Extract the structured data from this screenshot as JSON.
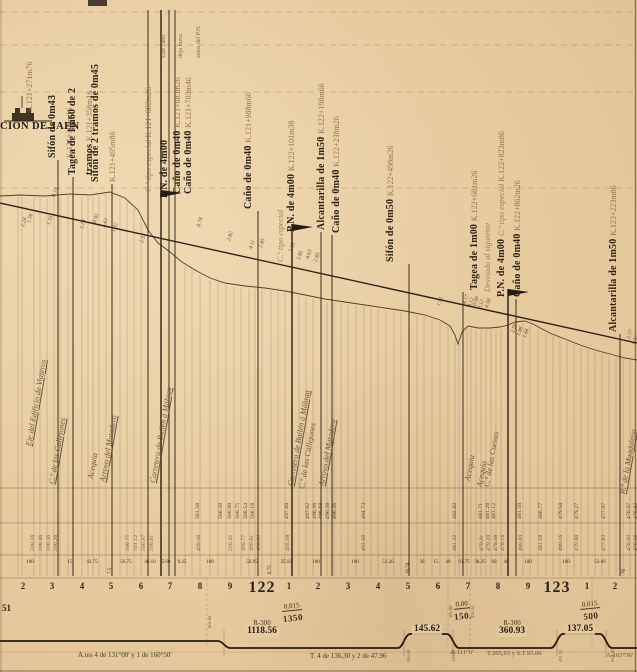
{
  "sheet": {
    "paper_color": "#e8cca1",
    "ink_color": "#33281b",
    "faded_ink_color": "#80603a"
  },
  "station": {
    "name": "CIÓN DE JAEN"
  },
  "events": [
    {
      "label_x": 19,
      "pole_x": null,
      "bottom": 112,
      "flag": false,
      "lines": [
        [
          {
            "t": "K.121+271m76",
            "s": "faded"
          }
        ]
      ]
    },
    {
      "label_x": 42,
      "pole_x": 58,
      "bottom": 158,
      "flag": false,
      "lines": [
        [
          {
            "t": "Sifón de 0m43",
            "s": "bold"
          }
        ],
        [
          {
            "t": "K.121+308m16",
            "s": "faded"
          }
        ]
      ]
    },
    {
      "label_x": 62,
      "pole_x": 73,
      "bottom": 175,
      "flag": false,
      "lines": [
        [
          {
            "t": "Tagea de 1m60 de 2",
            "s": "bold"
          }
        ],
        [
          {
            "t": "tramos ",
            "s": "bold"
          },
          {
            "t": "K.121+358m16",
            "s": "faded"
          }
        ]
      ]
    },
    {
      "label_x": 85,
      "pole_x": 112,
      "bottom": 182,
      "flag": false,
      "lines": [
        [
          {
            "t": "Sifón de 2 tramos de 0m45",
            "s": "bold"
          }
        ],
        [
          {
            "t": "K.121+495m86",
            "s": "faded"
          }
        ]
      ]
    },
    {
      "label_x": 138,
      "pole_x": 148,
      "bottom": 192,
      "line_top": 10,
      "flag": false,
      "lines": [
        [
          {
            "t": "C.º tipo especial ",
            "s": "faded-italic"
          },
          {
            "t": "K.121+682m26",
            "s": "faded"
          }
        ]
      ]
    },
    {
      "label_x": 152,
      "pole_x": null,
      "bottom": 58,
      "flag": false,
      "lines": [
        [
          {
            "t": "Este caño",
            "s": "tiny"
          }
        ],
        [
          {
            "t": "deja fuera",
            "s": "tiny"
          }
        ],
        [
          {
            "t": "antes del P.N.",
            "s": "tiny"
          }
        ]
      ]
    },
    {
      "label_x": 154,
      "pole_x": 161,
      "bottom": 198,
      "line_top": 10,
      "flag": true,
      "lines": [
        [
          {
            "t": "P.N. de 4m00",
            "s": "bold"
          }
        ]
      ]
    },
    {
      "label_x": 167,
      "pole_x": 169,
      "bottom": 194,
      "line_top": 10,
      "flag": false,
      "lines": [
        [
          {
            "t": "Caño de 0m40 ",
            "s": "bold"
          },
          {
            "t": "K.121+683m26",
            "s": "faded"
          }
        ]
      ]
    },
    {
      "label_x": 178,
      "pole_x": 175,
      "bottom": 194,
      "line_top": 10,
      "flag": false,
      "lines": [
        [
          {
            "t": "Caño de 0m40 ",
            "s": "bold"
          },
          {
            "t": "K.121+703m46",
            "s": "faded"
          }
        ]
      ]
    },
    {
      "label_x": 238,
      "pole_x": 258,
      "bottom": 209,
      "flag": false,
      "lines": [
        [
          {
            "t": "Caño de 0m40 ",
            "s": "bold"
          },
          {
            "t": "K.121+988m66",
            "s": "faded"
          }
        ]
      ]
    },
    {
      "label_x": 270,
      "pole_x": null,
      "bottom": 262,
      "flag": false,
      "lines": [
        [
          {
            "t": "C.º tipo especial",
            "s": "faded-italic"
          }
        ]
      ]
    },
    {
      "label_x": 281,
      "pole_x": 292,
      "bottom": 232,
      "flag": true,
      "lines": [
        [
          {
            "t": "P.N. de 4m00 ",
            "s": "bold"
          },
          {
            "t": "K.122+101m38",
            "s": "faded"
          }
        ]
      ]
    },
    {
      "label_x": 311,
      "pole_x": 321,
      "bottom": 230,
      "flag": false,
      "lines": [
        [
          {
            "t": "Alcantarilla de 1m50 ",
            "s": "bold"
          },
          {
            "t": "K.122+198m66",
            "s": "faded"
          }
        ]
      ]
    },
    {
      "label_x": 326,
      "pole_x": 332,
      "bottom": 233,
      "flag": false,
      "lines": [
        [
          {
            "t": "Caño de 0m40 ",
            "s": "bold"
          },
          {
            "t": "K.122+238m26",
            "s": "faded"
          }
        ]
      ]
    },
    {
      "label_x": 380,
      "pole_x": 409,
      "bottom": 262,
      "flag": false,
      "lines": [
        [
          {
            "t": "Sifón de 0m50 ",
            "s": "bold"
          },
          {
            "t": "K.122+498m26",
            "s": "faded"
          }
        ]
      ]
    },
    {
      "label_x": 464,
      "pole_x": 463,
      "bottom": 290,
      "flag": false,
      "lines": [
        [
          {
            "t": "Tagea de 1m00 ",
            "s": "bold"
          },
          {
            "t": "K.122+681m26",
            "s": "faded"
          }
        ]
      ]
    },
    {
      "label_x": 477,
      "pole_x": null,
      "bottom": 292,
      "flag": false,
      "lines": [
        [
          {
            "t": "Desviado al siguiente",
            "s": "faded-italic"
          }
        ]
      ]
    },
    {
      "label_x": 491,
      "pole_x": 508,
      "bottom": 297,
      "flag": true,
      "lines": [
        [
          {
            "t": "P.N. de 4m00 ",
            "s": "bold"
          },
          {
            "t": "C.º tipo especial ",
            "s": "faded-italic"
          },
          {
            "t": "K.122+823m86",
            "s": "faded"
          }
        ]
      ]
    },
    {
      "label_x": 507,
      "pole_x": 516,
      "bottom": 297,
      "flag": false,
      "lines": [
        [
          {
            "t": "Caño de 0m40 ",
            "s": "bold"
          },
          {
            "t": "K.122+862m26",
            "s": "faded"
          }
        ]
      ]
    },
    {
      "label_x": 603,
      "pole_x": 620,
      "bottom": 332,
      "flag": false,
      "lines": [
        [
          {
            "t": "Alcantarilla de 1m50 ",
            "s": "bold"
          },
          {
            "t": "K.123+223m86",
            "s": "faded"
          }
        ]
      ]
    }
  ],
  "features": [
    {
      "x": 24,
      "bottom": 445,
      "t": "Eje del Edificio de Viajeros",
      "u": true
    },
    {
      "x": 47,
      "bottom": 483,
      "t": "C.º de las Callejones",
      "u": true
    },
    {
      "x": 86,
      "bottom": 478,
      "t": "Acequia",
      "u": false
    },
    {
      "x": 98,
      "bottom": 481,
      "t": "Arroyo del Matadero",
      "u": true
    },
    {
      "x": 148,
      "bottom": 482,
      "t": "Carretera de Bailén á Málaga",
      "u": true
    },
    {
      "x": 286,
      "bottom": 485,
      "t": "Carretera de Bailén á Málaga",
      "u": true
    },
    {
      "x": 297,
      "bottom": 488,
      "t": "C.º de las Callejones",
      "u": false
    },
    {
      "x": 317,
      "bottom": 485,
      "t": "Arroyo del Matadero",
      "u": true
    },
    {
      "x": 463,
      "bottom": 480,
      "t": "Acequia",
      "u": false
    },
    {
      "x": 475,
      "bottom": 486,
      "t": "Acequia",
      "u": false
    },
    {
      "x": 482,
      "bottom": 486,
      "t": "C.ª de las Cuevas",
      "u": false
    },
    {
      "x": 618,
      "bottom": 493,
      "t": "R.º de la Magdalena",
      "u": true
    }
  ],
  "cutfill_numbers": [
    {
      "x": 20,
      "y": 226,
      "t": "1.24"
    },
    {
      "x": 26,
      "y": 222,
      "t": "1.56"
    },
    {
      "x": 46,
      "y": 224,
      "t": "1.35"
    },
    {
      "x": 51,
      "y": 196,
      "t": "0.19"
    },
    {
      "x": 79,
      "y": 228,
      "t": "1.74"
    },
    {
      "x": 92,
      "y": 222,
      "t": "0.95"
    },
    {
      "x": 101,
      "y": 227,
      "t": "1.43"
    },
    {
      "x": 111,
      "y": 231,
      "t": "1.32"
    },
    {
      "x": 139,
      "y": 242,
      "t": "2.37"
    },
    {
      "x": 196,
      "y": 226,
      "t": "0.78"
    },
    {
      "x": 226,
      "y": 240,
      "t": "2.82"
    },
    {
      "x": 248,
      "y": 248,
      "t": "4.11"
    },
    {
      "x": 258,
      "y": 247,
      "t": "2.85"
    },
    {
      "x": 288,
      "y": 251,
      "t": "2.18"
    },
    {
      "x": 296,
      "y": 259,
      "t": "2.85"
    },
    {
      "x": 305,
      "y": 258,
      "t": "4.63"
    },
    {
      "x": 313,
      "y": 261,
      "t": "2.85"
    },
    {
      "x": 436,
      "y": 305,
      "t": "1.51"
    },
    {
      "x": 462,
      "y": 303,
      "t": "4.17"
    },
    {
      "x": 467,
      "y": 306,
      "t": "4.12"
    },
    {
      "x": 472,
      "y": 305,
      "t": "0.98"
    },
    {
      "x": 477,
      "y": 308,
      "t": "0.12"
    },
    {
      "x": 484,
      "y": 307,
      "t": "4.50"
    },
    {
      "x": 510,
      "y": 332,
      "t": "2.56"
    },
    {
      "x": 516,
      "y": 335,
      "t": "1.08"
    },
    {
      "x": 522,
      "y": 337,
      "t": "1.66"
    },
    {
      "x": 626,
      "y": 338,
      "t": "2.77"
    },
    {
      "x": 631,
      "y": 344,
      "t": "1.42"
    }
  ],
  "elevation_rows": {
    "terrain": [
      {
        "x": 195,
        "t": "501.56"
      },
      {
        "x": 218,
        "t": "500.50"
      },
      {
        "x": 227,
        "t": "500.90"
      },
      {
        "x": 235,
        "t": "500.75"
      },
      {
        "x": 243,
        "t": "500.54"
      },
      {
        "x": 250,
        "t": "500.16"
      },
      {
        "x": 284,
        "t": "497.88"
      },
      {
        "x": 305,
        "t": "497.02"
      },
      {
        "x": 312,
        "t": "496.96"
      },
      {
        "x": 318,
        "t": "496.68"
      },
      {
        "x": 325,
        "t": "496.38"
      },
      {
        "x": 332,
        "t": "496.26"
      },
      {
        "x": 361,
        "t": "494.73"
      },
      {
        "x": 452,
        "t": "482.82"
      },
      {
        "x": 478,
        "t": "481.71"
      },
      {
        "x": 485,
        "t": "481.26"
      },
      {
        "x": 491,
        "t": "481.12"
      },
      {
        "x": 517,
        "t": "481.50"
      },
      {
        "x": 538,
        "t": "480.77"
      },
      {
        "x": 558,
        "t": "479.58"
      },
      {
        "x": 574,
        "t": "479.27"
      },
      {
        "x": 601,
        "t": "477.97"
      },
      {
        "x": 626,
        "t": "476.97"
      },
      {
        "x": 633,
        "t": "476.82"
      }
    ],
    "grade": [
      {
        "x": 30,
        "t": "500.56"
      },
      {
        "x": 38,
        "t": "500.46"
      },
      {
        "x": 46,
        "t": "500.36"
      },
      {
        "x": 53,
        "t": "500.26"
      },
      {
        "x": 125,
        "t": "500.75"
      },
      {
        "x": 133,
        "t": "501.12"
      },
      {
        "x": 141,
        "t": "500.97"
      },
      {
        "x": 149,
        "t": "500.81"
      },
      {
        "x": 196,
        "t": "499.06"
      },
      {
        "x": 228,
        "t": "500.35"
      },
      {
        "x": 241,
        "t": "499.77"
      },
      {
        "x": 249,
        "t": "499.61"
      },
      {
        "x": 256,
        "t": "498.80"
      },
      {
        "x": 285,
        "t": "495.08"
      },
      {
        "x": 361,
        "t": "491.68"
      },
      {
        "x": 452,
        "t": "481.32"
      },
      {
        "x": 479,
        "t": "479.31"
      },
      {
        "x": 486,
        "t": "479.20"
      },
      {
        "x": 493,
        "t": "478.08"
      },
      {
        "x": 500,
        "t": "478.16"
      },
      {
        "x": 518,
        "t": "480.80"
      },
      {
        "x": 538,
        "t": "481.68"
      },
      {
        "x": 558,
        "t": "480.16"
      },
      {
        "x": 574,
        "t": "479.88"
      },
      {
        "x": 601,
        "t": "477.83"
      },
      {
        "x": 626,
        "t": "478.90"
      },
      {
        "x": 633,
        "t": "476.98"
      }
    ]
  },
  "distances": [
    {
      "x": 30,
      "t": "100",
      "v": false
    },
    {
      "x": 70,
      "t": "15",
      "v": false
    },
    {
      "x": 92,
      "t": "43.75",
      "v": false
    },
    {
      "x": 108,
      "t": "7.5",
      "v": true
    },
    {
      "x": 126,
      "t": "56.75",
      "v": false
    },
    {
      "x": 150,
      "t": "46.10",
      "v": false
    },
    {
      "x": 166,
      "t": "5.60",
      "v": false
    },
    {
      "x": 182,
      "t": "9.25",
      "v": false
    },
    {
      "x": 210,
      "t": "100",
      "v": false
    },
    {
      "x": 252,
      "t": "56.95",
      "v": false
    },
    {
      "x": 268,
      "t": "8.75",
      "v": true
    },
    {
      "x": 286,
      "t": "35.10",
      "v": false
    },
    {
      "x": 316,
      "t": "100",
      "v": false
    },
    {
      "x": 355,
      "t": "100",
      "v": false
    },
    {
      "x": 388,
      "t": "51.26",
      "v": false
    },
    {
      "x": 406,
      "t": "16.74",
      "v": true
    },
    {
      "x": 422,
      "t": "36",
      "v": false
    },
    {
      "x": 436,
      "t": "15",
      "v": false
    },
    {
      "x": 448,
      "t": "40",
      "v": false
    },
    {
      "x": 464,
      "t": "61.75",
      "v": false
    },
    {
      "x": 480,
      "t": "38.25",
      "v": false
    },
    {
      "x": 494,
      "t": "60",
      "v": false
    },
    {
      "x": 506,
      "t": "40",
      "v": false
    },
    {
      "x": 528,
      "t": "100",
      "v": false
    },
    {
      "x": 566,
      "t": "100",
      "v": false
    },
    {
      "x": 600,
      "t": "53.66",
      "v": false
    },
    {
      "x": 622,
      "t": "76",
      "v": true
    }
  ],
  "hectometers": [
    {
      "x": 23,
      "t": "2"
    },
    {
      "x": 52,
      "t": "3"
    },
    {
      "x": 82,
      "t": "4"
    },
    {
      "x": 111,
      "t": "5"
    },
    {
      "x": 141,
      "t": "6"
    },
    {
      "x": 170,
      "t": "7"
    },
    {
      "x": 200,
      "t": "8"
    },
    {
      "x": 230,
      "t": "9"
    },
    {
      "x": 289,
      "t": "1"
    },
    {
      "x": 318,
      "t": "2"
    },
    {
      "x": 348,
      "t": "3"
    },
    {
      "x": 378,
      "t": "4"
    },
    {
      "x": 408,
      "t": "5"
    },
    {
      "x": 438,
      "t": "6"
    },
    {
      "x": 468,
      "t": "7"
    },
    {
      "x": 498,
      "t": "8"
    },
    {
      "x": 528,
      "t": "9"
    },
    {
      "x": 587,
      "t": "1"
    },
    {
      "x": 615,
      "t": "2"
    }
  ],
  "km_posts": [
    {
      "x": 262,
      "label": "122"
    },
    {
      "x": 557,
      "label": "123"
    }
  ],
  "gradients": [
    {
      "x": 292,
      "y": 595,
      "num": "0.015",
      "den": "1350"
    },
    {
      "x": 462,
      "y": 593,
      "num": "0.00",
      "den": "150."
    },
    {
      "x": 590,
      "y": 593,
      "num": "0.015",
      "den": "500"
    }
  ],
  "band_stations": [
    {
      "x": 207,
      "bottom": 628,
      "t": "866.04"
    },
    {
      "x": 448,
      "bottom": 618,
      "t": "306.08"
    },
    {
      "x": 470,
      "bottom": 618,
      "t": "456.44"
    },
    {
      "x": 406,
      "bottom": 662,
      "t": "984.60"
    },
    {
      "x": 451,
      "bottom": 662,
      "t": "130.22"
    },
    {
      "x": 558,
      "bottom": 662,
      "t": "491.15"
    },
    {
      "x": 610,
      "bottom": 662,
      "t": "628.20"
    }
  ],
  "curve_band": {
    "left_label": "51",
    "segments": [
      {
        "cx": 262,
        "y": 620,
        "r": "R-300",
        "len": "1118.56"
      },
      {
        "cx": 427,
        "y": 625,
        "r": "",
        "len": "145.62"
      },
      {
        "cx": 512,
        "y": 620,
        "r": "R-300",
        "len": "360.93"
      },
      {
        "cx": 580,
        "y": 625,
        "r": "",
        "len": "137.05"
      }
    ],
    "angle_notes": [
      {
        "x": 450,
        "y": 649,
        "t": "A-111°6'"
      },
      {
        "x": 487,
        "y": 650,
        "t": "T.205,93 y S.T.93.06"
      },
      {
        "x": 606,
        "y": 652,
        "t": "A-103°36'"
      }
    ],
    "notes": [
      {
        "x": 78,
        "y": 651,
        "t": "A.tes 4 de 131°08' y 1 de 160°50'"
      },
      {
        "x": 310,
        "y": 652,
        "t": "T. 4 de 136,30 y 2 de 47.96"
      }
    ]
  }
}
